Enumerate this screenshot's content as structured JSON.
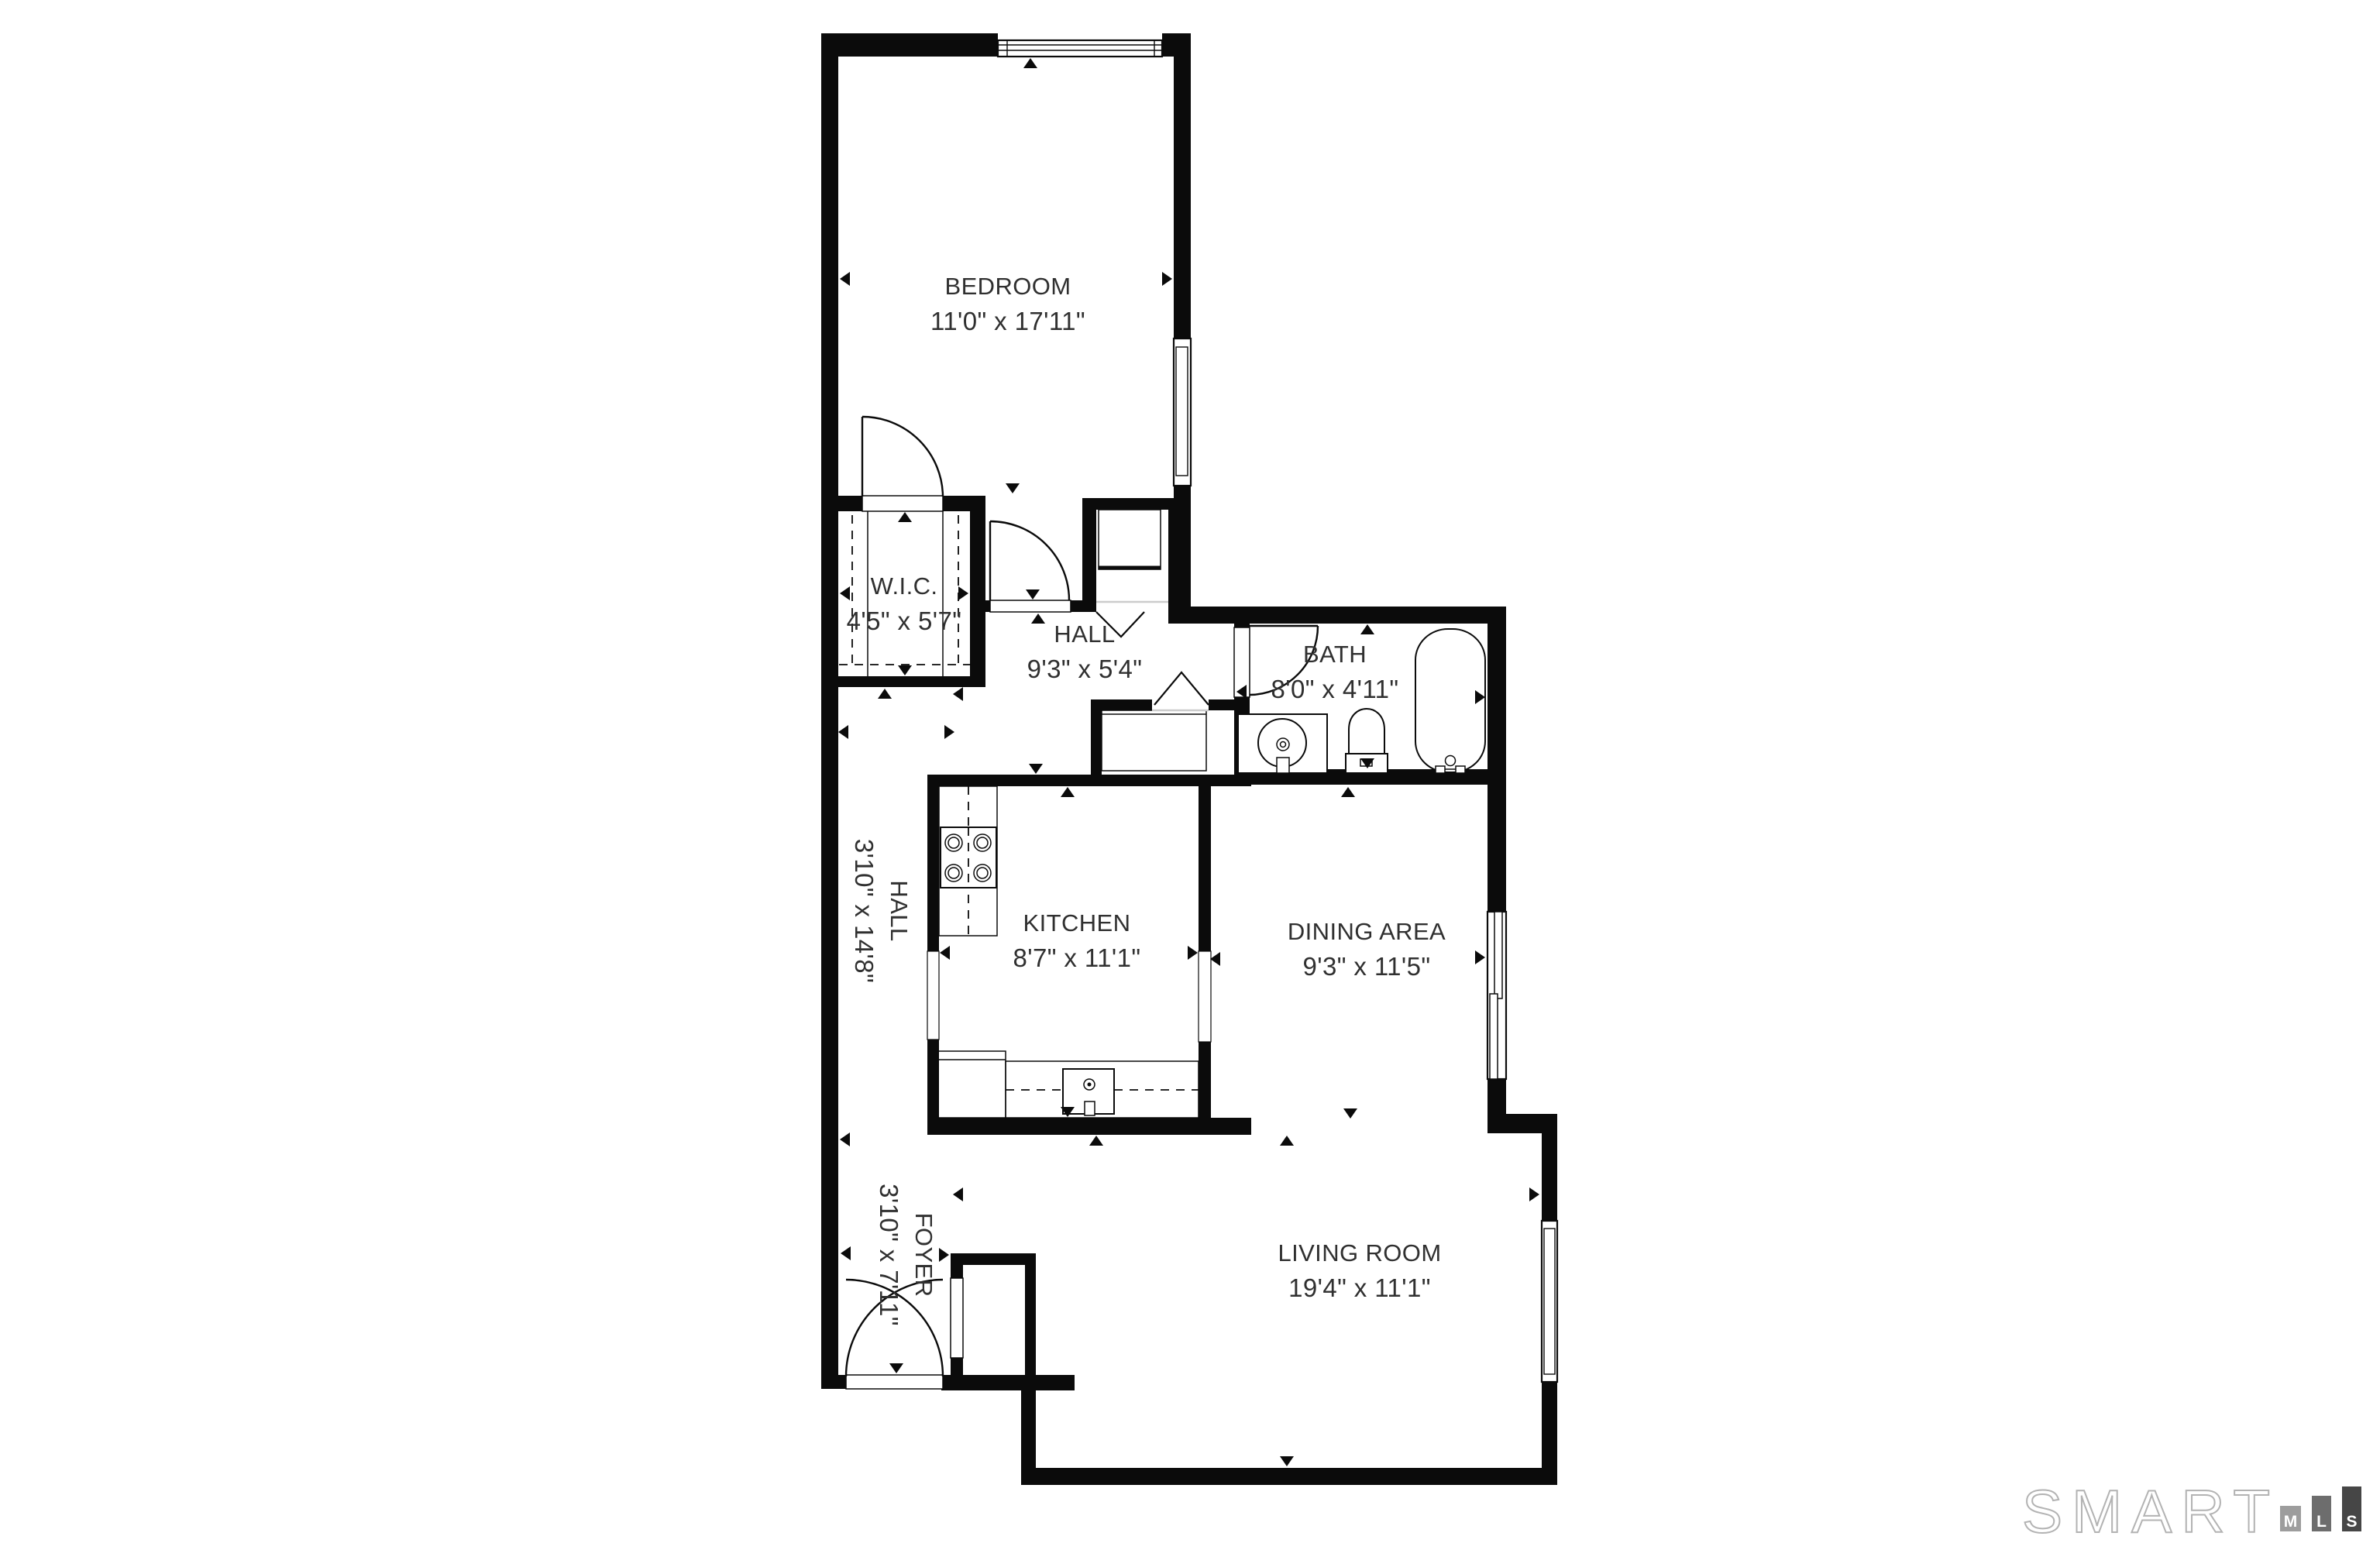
{
  "floor_plan": {
    "rooms": [
      {
        "id": "bedroom",
        "name": "BEDROOM",
        "dims": "11'0\" x 17'11\""
      },
      {
        "id": "wic",
        "name": "W.I.C.",
        "dims": "4'5\" x 5'7\""
      },
      {
        "id": "hall_upper",
        "name": "HALL",
        "dims": "9'3\" x 5'4\""
      },
      {
        "id": "bath",
        "name": "BATH",
        "dims": "8'0\" x 4'11\""
      },
      {
        "id": "kitchen",
        "name": "KITCHEN",
        "dims": "8'7\" x 11'1\""
      },
      {
        "id": "dining_area",
        "name": "DINING AREA",
        "dims": "9'3\" x 11'5\""
      },
      {
        "id": "hall_vertical",
        "name": "HALL",
        "dims": "3'10\" x 14'8\""
      },
      {
        "id": "foyer",
        "name": "FOYER",
        "dims": "3'10\" x 7'11\""
      },
      {
        "id": "living_room",
        "name": "LIVING ROOM",
        "dims": "19'4\" x 11'1\""
      }
    ]
  },
  "logo": {
    "brand": "SMART",
    "bars": [
      "M",
      "L",
      "S"
    ]
  },
  "colors": {
    "wall": "#0b0b0b",
    "label_text": "#303030",
    "background": "#ffffff",
    "threshold_gray": "#cccccc",
    "logo_outline": "#b3b3b3",
    "logo_bar_m": "#9d9d9d",
    "logo_bar_l": "#6d6d6d",
    "logo_bar_s": "#464646",
    "logo_letter": "#ffffff"
  }
}
